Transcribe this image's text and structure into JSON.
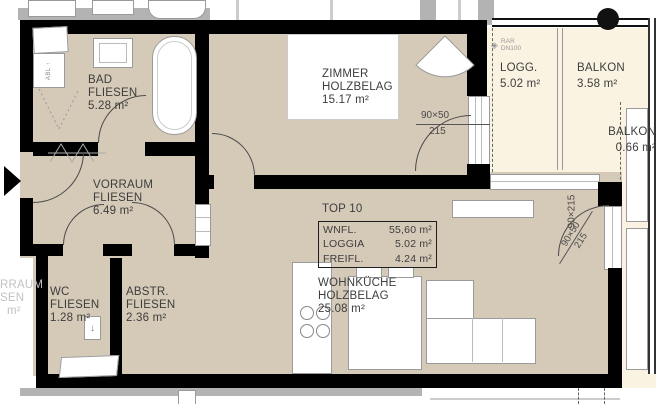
{
  "unit": {
    "title": "TOP 10",
    "metrics": [
      {
        "label": "WNFL.",
        "value": "55,60 m²"
      },
      {
        "label": "LOGGIA",
        "value": "5.02 m²"
      },
      {
        "label": "FREIFL.",
        "value": "4.24 m²"
      }
    ]
  },
  "rooms": {
    "bad": {
      "name": "BAD",
      "finish": "FLIESEN",
      "area": "5.28 m²"
    },
    "zimmer": {
      "name": "ZIMMER",
      "finish": "HOLZBELAG",
      "area": "15.17 m²"
    },
    "loggia": {
      "name": "LOGG.",
      "area": "5.02 m²"
    },
    "balkon": {
      "name": "BALKON",
      "area": "3.58 m²"
    },
    "balkon2": {
      "name": "BALKON",
      "area": "0.66 m²"
    },
    "vorraum": {
      "name": "VORRAUM",
      "finish": "FLIESEN",
      "area": "6.49 m²"
    },
    "wc": {
      "name": "WC",
      "finish": "FLIESEN",
      "area": "1.28 m²"
    },
    "abstellraum": {
      "name": "ABSTR.",
      "finish": "FLIESEN",
      "area": "2.36 m²"
    },
    "wohnkueche": {
      "name": "WOHNKÜCHE",
      "finish": "HOLZBELAG",
      "area": "25.08 m²"
    }
  },
  "annotations": {
    "window_zimmer": {
      "size": "90×50",
      "parapet": "215"
    },
    "door_balkon": {
      "size": "90×215"
    },
    "window_balkon": {
      "size": "90×50",
      "parapet": "215"
    },
    "drain": {
      "line1": "RAR",
      "line2": "DN100"
    },
    "washer": "ABL ↑",
    "vent_arrow": "↓"
  },
  "neighbor_left": {
    "line1": "RRAUM",
    "line2": "SEN",
    "line3": "m²"
  },
  "colors": {
    "floor": "#d5cab8",
    "balcony": "#faf3e2",
    "wall": "#000000",
    "neighbor": "#b3b3b3",
    "text": "#3d3d3d"
  }
}
